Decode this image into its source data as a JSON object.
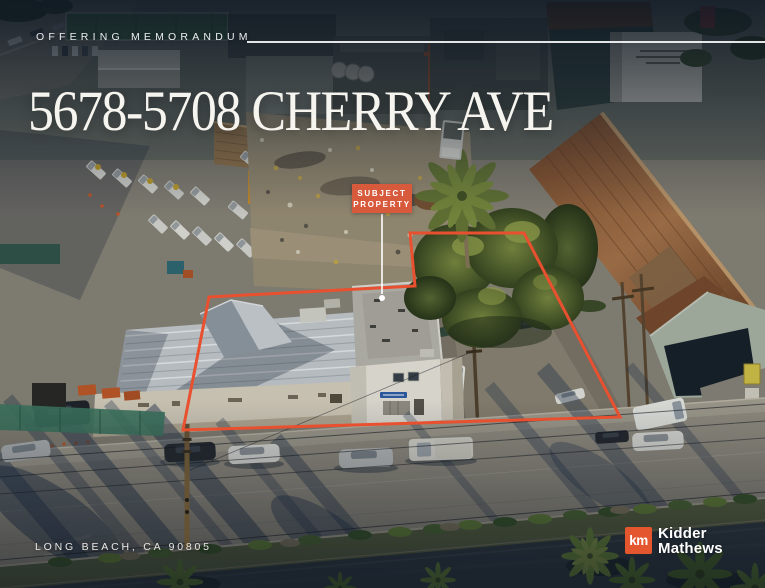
{
  "header": {
    "eyebrow": "OFFERING MEMORANDUM",
    "title": "5678-5708 CHERRY AVE"
  },
  "property_callout": {
    "label_line1": "SUBJECT",
    "label_line2": "PROPERTY"
  },
  "footer": {
    "location": "LONG BEACH, CA 90805",
    "brand": {
      "monogram": "km",
      "name_line1": "Kidder",
      "name_line2": "Mathews"
    }
  },
  "colors": {
    "accent": "#E4572E",
    "callout_bg": "#D85A3C",
    "outline_stroke": "#E8502F",
    "title_color": "#F6F4EF"
  }
}
